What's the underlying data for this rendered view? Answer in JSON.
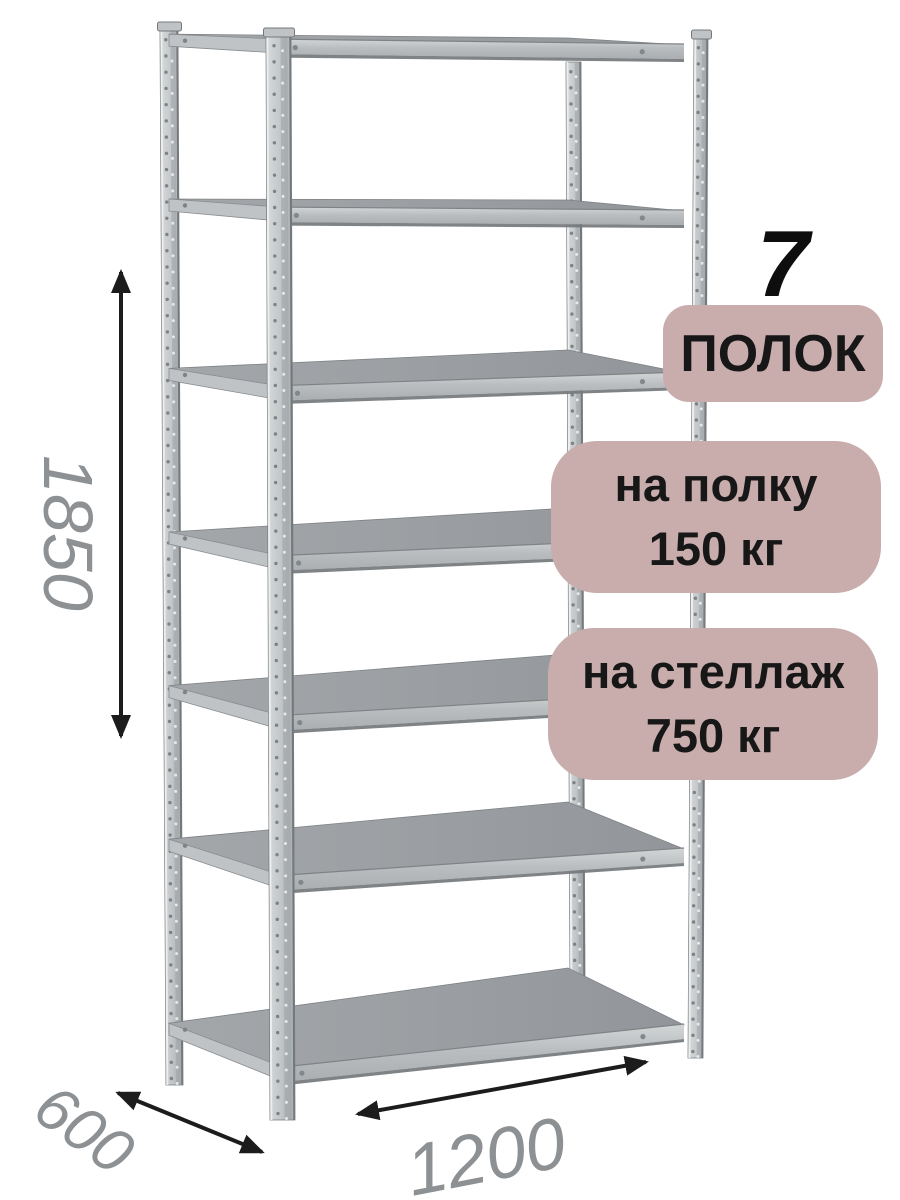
{
  "badges": {
    "shelf_count": {
      "number": "7",
      "label": "ПОЛОК"
    },
    "shelf_load": {
      "line1": "на полку",
      "line2": "150 кг"
    },
    "rack_load": {
      "line1": "на стеллаж",
      "line2": "750 кг"
    }
  },
  "dimensions": {
    "height": "1850",
    "depth": "600",
    "width": "1200"
  },
  "product": {
    "shelves_count": 7,
    "posts_count": 4
  },
  "colors": {
    "background": "#ffffff",
    "badge_bg": "#c9acac",
    "badge_text": "#171717",
    "big_number": "#0e0e0e",
    "dim_text": "#8d9194",
    "arrow": "#1c1c1c",
    "metal_light": "#d8dbdc",
    "metal_mid": "#bfc3c5",
    "metal_dark": "#9aa0a3",
    "surface_light": "#a4a7aa",
    "surface_dark": "#92969a",
    "band_light": "#d3d6d7",
    "band_mid": "#b4b8ba",
    "edge_dark": "#74787b"
  }
}
